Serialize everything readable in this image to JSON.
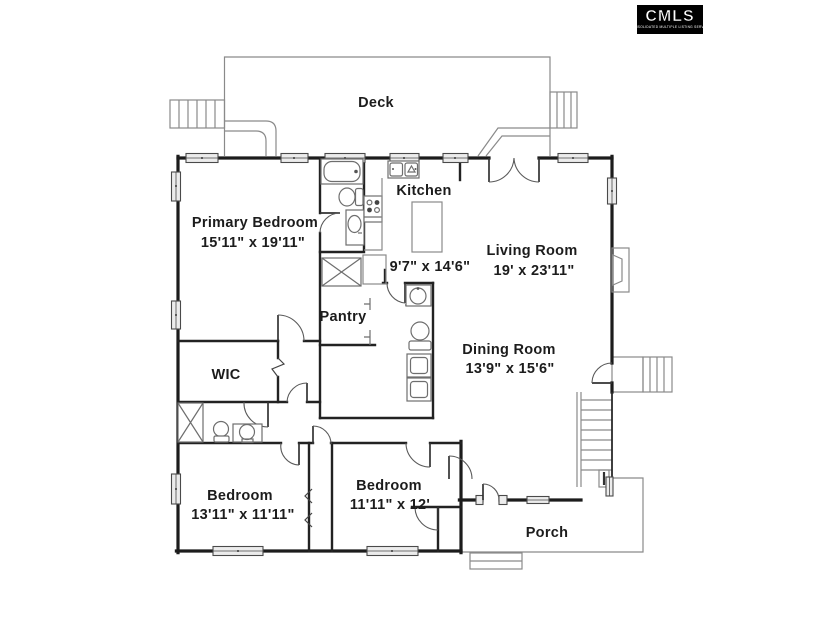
{
  "logo": {
    "brand": "CMLS",
    "caption": "CONSOLIDATED MULTIPLE LISTING SERVICE"
  },
  "colors": {
    "wall": "#1c1c1c",
    "thin_line": "#8a8a8a",
    "text": "#1c1c1c",
    "background": "#ffffff",
    "logo_bg": "#000000",
    "logo_text": "#ffffff"
  },
  "rooms": {
    "deck": {
      "name": "Deck",
      "dims": ""
    },
    "kitchen": {
      "name": "Kitchen",
      "dims": "9'7\" x 14'6\""
    },
    "primary_bedroom": {
      "name": "Primary Bedroom",
      "dims": "15'11\" x 19'11\""
    },
    "living_room": {
      "name": "Living Room",
      "dims": "19' x 23'11\""
    },
    "pantry": {
      "name": "Pantry",
      "dims": ""
    },
    "dining_room": {
      "name": "Dining Room",
      "dims": "13'9\" x 15'6\""
    },
    "wic": {
      "name": "WIC",
      "dims": ""
    },
    "bedroom_left": {
      "name": "Bedroom",
      "dims": "13'11\" x 11'11\""
    },
    "bedroom_right": {
      "name": "Bedroom",
      "dims": "11'11\" x 12'"
    },
    "porch": {
      "name": "Porch",
      "dims": ""
    }
  }
}
